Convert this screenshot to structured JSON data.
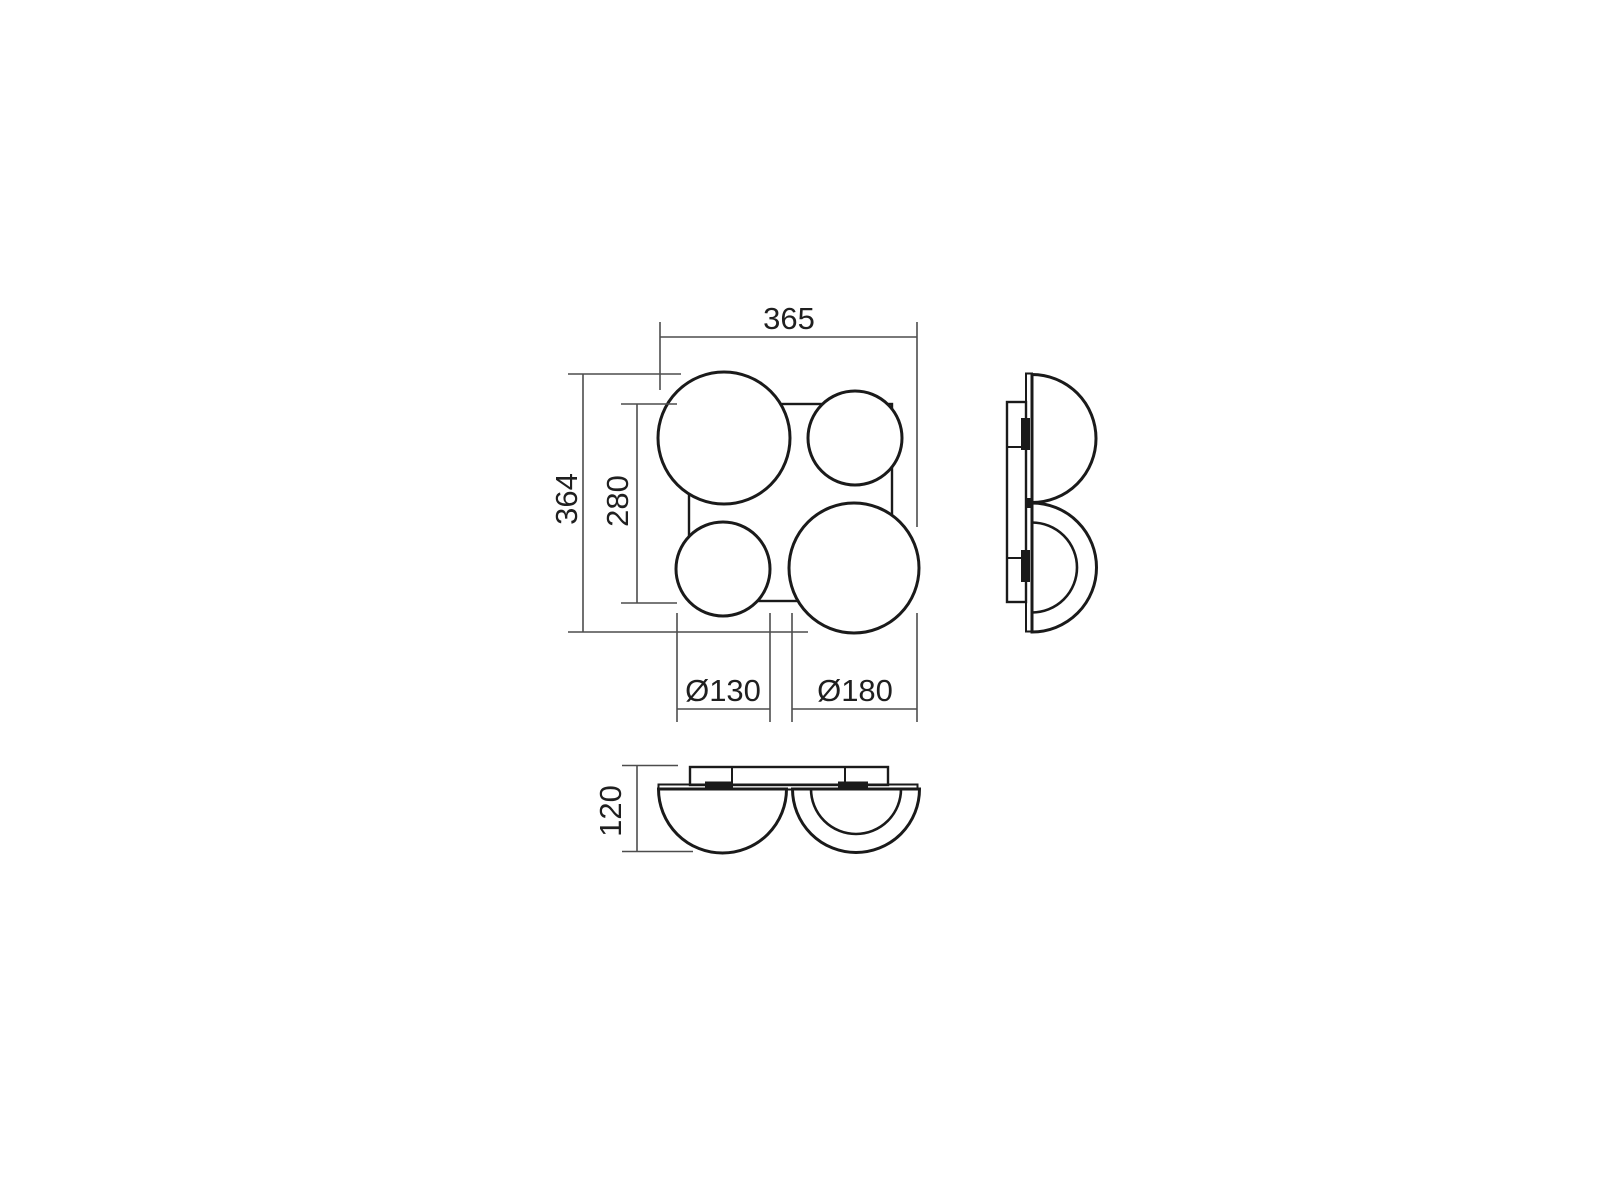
{
  "page": {
    "background_color": "#ffffff",
    "description": "Technical dimension drawing of a four-dome ceiling lamp: front view (top left), side view (right), bottom view (below)"
  },
  "colors": {
    "object_line": "#1a1a1a",
    "dimension_line": "#4d4d4d",
    "label_text": "#1f1f1f",
    "surface_fill": "#ffffff"
  },
  "front_view": {
    "labels": {
      "overall_width": "365",
      "overall_height": "364",
      "backplate_size": "280",
      "small_shade_diameter": "Ø130",
      "large_shade_diameter": "Ø180"
    }
  },
  "bottom_view": {
    "labels": {
      "fixture_depth": "120"
    }
  }
}
